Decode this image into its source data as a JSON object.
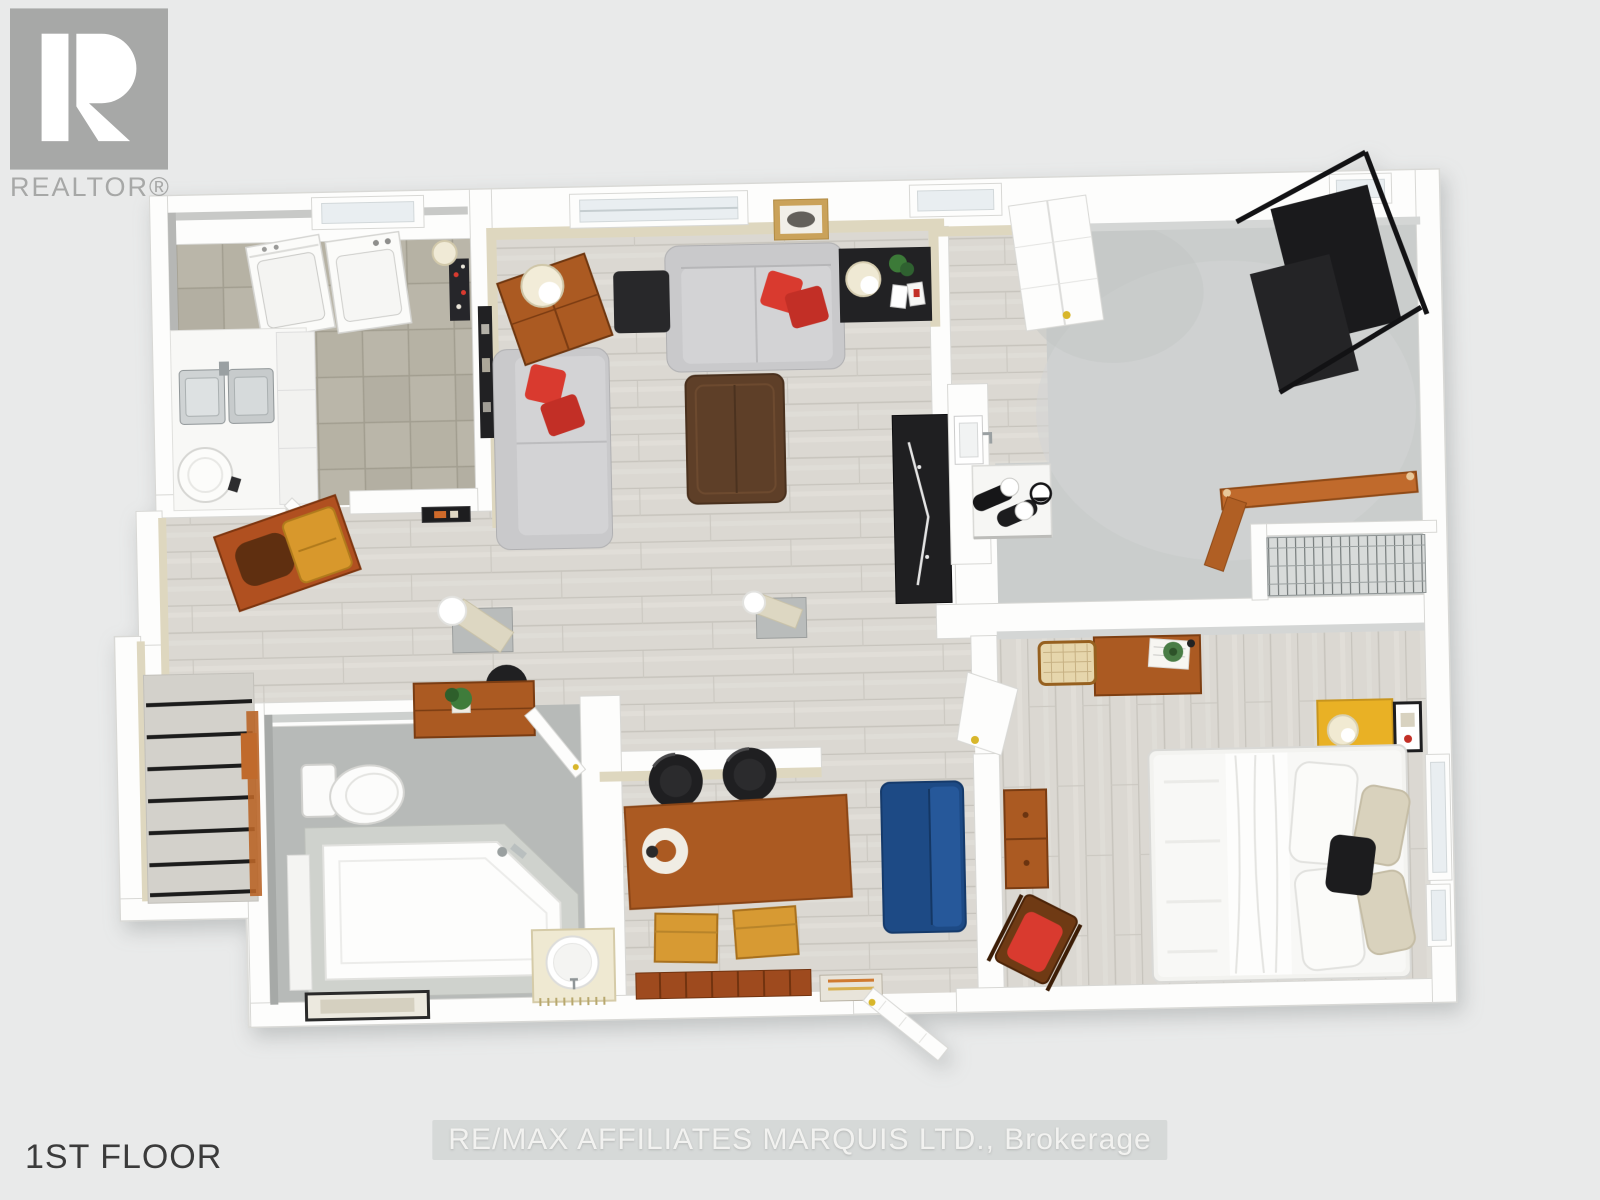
{
  "branding": {
    "logo_icon": "realtor-r-icon",
    "realtor_label": "REALTOR®"
  },
  "footer": {
    "floor_label": "1ST FLOOR"
  },
  "watermark": {
    "brokerage": "RE/MAX AFFILIATES MARQUIS LTD., Brokerage"
  },
  "colors": {
    "background": "#e9eaea",
    "plan_wall": "#fdfdfc",
    "wall_shadow": "#d8d8d5",
    "beige_wall": "#ded7bf",
    "wood_floor": "#dbd8d2",
    "tile_floor": "#bab6a9",
    "concrete_floor": "#cacdcc",
    "bath_floor": "#b7bab8",
    "sofa_gray": "#c9c9cb",
    "accent_red": "#d93a2f",
    "wood_brown": "#ab5a22",
    "wood_dark": "#5e3f28",
    "black_furniture": "#222224",
    "blue_sofa": "#1d4a85",
    "yellow_accent": "#e9b125",
    "stair_rail": "#c06a2c",
    "logo_gray": "#a7a8a7",
    "floor_label_color": "#3b3b3b",
    "watermark_color": "#f2f2f0"
  }
}
